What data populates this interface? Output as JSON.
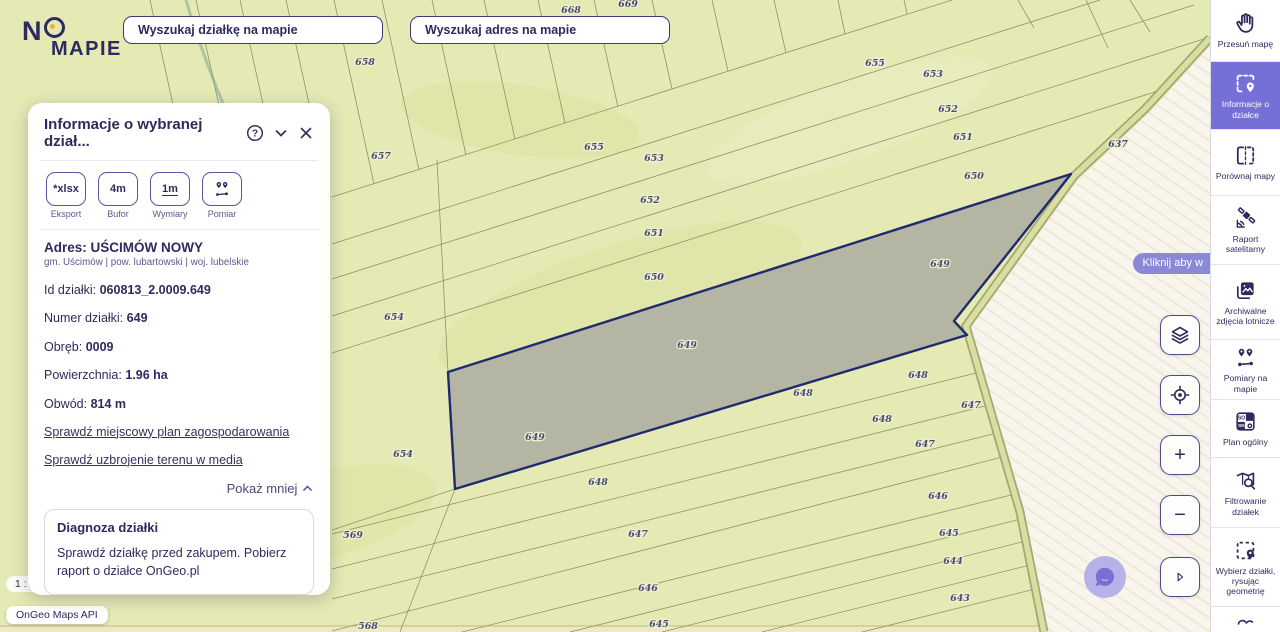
{
  "brand": {
    "line1": "N",
    "line2": "MAPIE"
  },
  "search": {
    "parcel_placeholder": "Wyszukaj działkę na mapie",
    "address_placeholder": "Wyszukaj adres na mapie"
  },
  "panel": {
    "title": "Informacje o wybranej dział...",
    "tools": [
      {
        "glyph": "*xlsx",
        "label": "Eksport"
      },
      {
        "glyph": "4m",
        "label": "Bufor"
      },
      {
        "glyph": "1m",
        "label": "Wymiary"
      },
      {
        "glyph": "",
        "label": "Pomiar"
      }
    ],
    "address_label": "Adres:",
    "address_value": "UŚCIMÓW NOWY",
    "address_sub": "gm. Uścimów | pow. lubartowski | woj. lubelskie",
    "fields": [
      {
        "label": "Id działki:",
        "value": "060813_2.0009.649"
      },
      {
        "label": "Numer działki:",
        "value": "649"
      },
      {
        "label": "Obręb:",
        "value": "0009"
      },
      {
        "label": "Powierzchnia:",
        "value": "1.96 ha"
      },
      {
        "label": "Obwód:",
        "value": "814 m"
      }
    ],
    "links": [
      {
        "text": "Sprawdź miejscowy plan zagospodarowania"
      },
      {
        "text": "Sprawdź uzbrojenie terenu w media"
      }
    ],
    "collapse_label": "Pokaż mniej",
    "promo": {
      "title": "Diagnoza działki",
      "text": "Sprawdź działkę przed zakupem. Pobierz raport o działce OnGeo.pl"
    }
  },
  "sidebar": {
    "items": [
      {
        "label": "Przesuń mapę"
      },
      {
        "label": "Informacje o działce"
      },
      {
        "label": "Porównaj mapy"
      },
      {
        "label": "Raport satelitarny"
      },
      {
        "label": "Archiwalne zdjęcia lotnicze"
      },
      {
        "label": "Pomiary na mapie"
      },
      {
        "label": "Plan ogólny"
      },
      {
        "label": "Filtrowanie działek"
      },
      {
        "label": "Wybierz działki, rysując geometrię"
      }
    ],
    "plan_tiles": {
      "a": "SO",
      "b": "SK"
    }
  },
  "map": {
    "tooltip": "Kliknij aby w",
    "scale": "1 : 1027",
    "attribution": "OnGeo Maps API",
    "selected_parcel_number": "649",
    "labels": [
      {
        "x": 571,
        "y": 13,
        "t": "668"
      },
      {
        "x": 628,
        "y": 7,
        "t": "669"
      },
      {
        "x": 365,
        "y": 65,
        "t": "658"
      },
      {
        "x": 381,
        "y": 159,
        "t": "657"
      },
      {
        "x": 594,
        "y": 150,
        "t": "655"
      },
      {
        "x": 654,
        "y": 161,
        "t": "653"
      },
      {
        "x": 650,
        "y": 203,
        "t": "652"
      },
      {
        "x": 654,
        "y": 236,
        "t": "651"
      },
      {
        "x": 654,
        "y": 280,
        "t": "650"
      },
      {
        "x": 875,
        "y": 66,
        "t": "655"
      },
      {
        "x": 933,
        "y": 77,
        "t": "653"
      },
      {
        "x": 948,
        "y": 112,
        "t": "652"
      },
      {
        "x": 963,
        "y": 140,
        "t": "651"
      },
      {
        "x": 974,
        "y": 179,
        "t": "650"
      },
      {
        "x": 1118,
        "y": 147,
        "t": "637"
      },
      {
        "x": 940,
        "y": 267,
        "t": "649"
      },
      {
        "x": 687,
        "y": 348,
        "t": "649"
      },
      {
        "x": 535,
        "y": 440,
        "t": "649"
      },
      {
        "x": 394,
        "y": 320,
        "t": "654"
      },
      {
        "x": 403,
        "y": 457,
        "t": "654"
      },
      {
        "x": 918,
        "y": 378,
        "t": "648"
      },
      {
        "x": 803,
        "y": 396,
        "t": "648"
      },
      {
        "x": 882,
        "y": 422,
        "t": "648"
      },
      {
        "x": 971,
        "y": 408,
        "t": "647"
      },
      {
        "x": 925,
        "y": 447,
        "t": "647"
      },
      {
        "x": 598,
        "y": 485,
        "t": "648"
      },
      {
        "x": 938,
        "y": 499,
        "t": "646"
      },
      {
        "x": 353,
        "y": 538,
        "t": "569"
      },
      {
        "x": 638,
        "y": 537,
        "t": "647"
      },
      {
        "x": 949,
        "y": 536,
        "t": "645"
      },
      {
        "x": 953,
        "y": 564,
        "t": "644"
      },
      {
        "x": 648,
        "y": 591,
        "t": "646"
      },
      {
        "x": 960,
        "y": 601,
        "t": "643"
      },
      {
        "x": 368,
        "y": 629,
        "t": "568"
      },
      {
        "x": 659,
        "y": 627,
        "t": "645"
      }
    ]
  },
  "colors": {
    "accent_purple": "#7470d6",
    "navy": "#2d2b5e",
    "map_green": "#e5e9b3",
    "parcel_fill": "#b4b5a3",
    "parcel_border": "#1e2b6e",
    "tooltip_purple": "#8c88d8"
  }
}
